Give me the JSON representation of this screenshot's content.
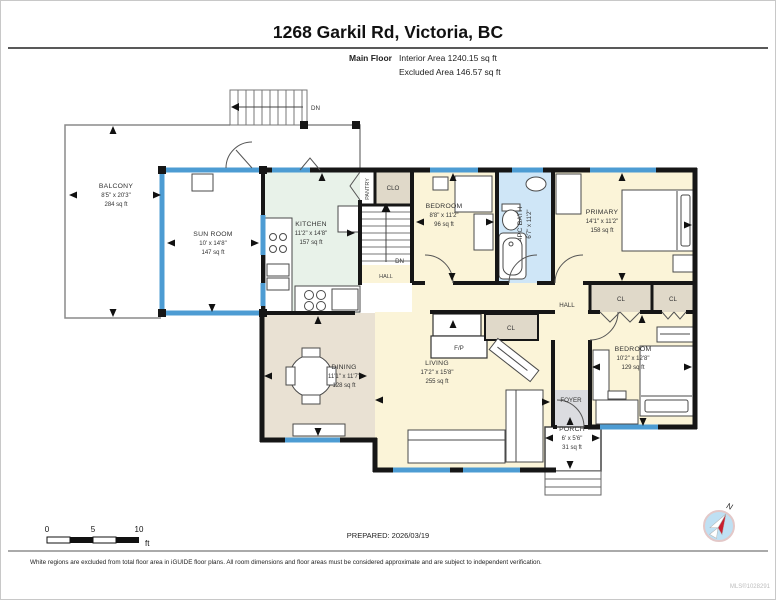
{
  "header": {
    "title": "1268 Garkil Rd, Victoria, BC",
    "floor_label": "Main Floor",
    "interior_area": "Interior Area 1240.15 sq ft",
    "excluded_area": "Excluded Area 146.57 sq ft"
  },
  "rooms": {
    "balcony": {
      "name": "BALCONY",
      "dims": "8'5\" x 20'3\"",
      "area": "284 sq ft"
    },
    "sunroom": {
      "name": "SUN ROOM",
      "dims": "10' x 14'8\"",
      "area": "147 sq ft"
    },
    "kitchen": {
      "name": "KITCHEN",
      "dims": "11'2\" x 14'8\"",
      "area": "157 sq ft"
    },
    "bedroom1": {
      "name": "BEDROOM",
      "dims": "8'8\" x 11'2\"",
      "area": "96 sq ft"
    },
    "bath": {
      "name": "4PC BATH",
      "dims": "6'7\" x 11'2\""
    },
    "primary": {
      "name": "PRIMARY",
      "dims": "14'1\" x 11'2\"",
      "area": "158 sq ft"
    },
    "bedroom2": {
      "name": "BEDROOM",
      "dims": "10'2\" x 12'8\"",
      "area": "129 sq ft"
    },
    "dining": {
      "name": "DINING",
      "dims": "11'1\" x 11'7\"",
      "area": "128 sq ft"
    },
    "living": {
      "name": "LIVING",
      "dims": "17'2\" x 15'8\"",
      "area": "255 sq ft"
    },
    "porch": {
      "name": "PORCH",
      "dims": "6' x 5'6\"",
      "area": "31 sq ft"
    }
  },
  "labels": {
    "hall": "HALL",
    "foyer": "FOYER",
    "pantry": "PANTRY",
    "clo": "CLO",
    "cl": "CL",
    "fp": "F/P",
    "dn": "DN",
    "north": "N"
  },
  "colors": {
    "wall": "#161616",
    "window_blue": "#4d9cd3",
    "cream": "#fbf4d8",
    "kitchen_green": "#e8f2e9",
    "bath_blue": "#cfe6f7",
    "dining_tan": "#e9e1d3",
    "closet_tan": "#e0d9c9",
    "foyer_gray": "#dbdce0",
    "compass_red": "#c8202f"
  },
  "scale_bar": {
    "t0": "0",
    "t5": "5",
    "t10": "10",
    "unit": "ft"
  },
  "footer": {
    "prepared": "PREPARED: 2026/03/19",
    "disclaimer": "White regions are excluded from total floor area in iGUIDE floor plans. All room dimensions and floor areas must be considered approximate and are subject to independent verification.",
    "mls": "MLS®1028291"
  }
}
